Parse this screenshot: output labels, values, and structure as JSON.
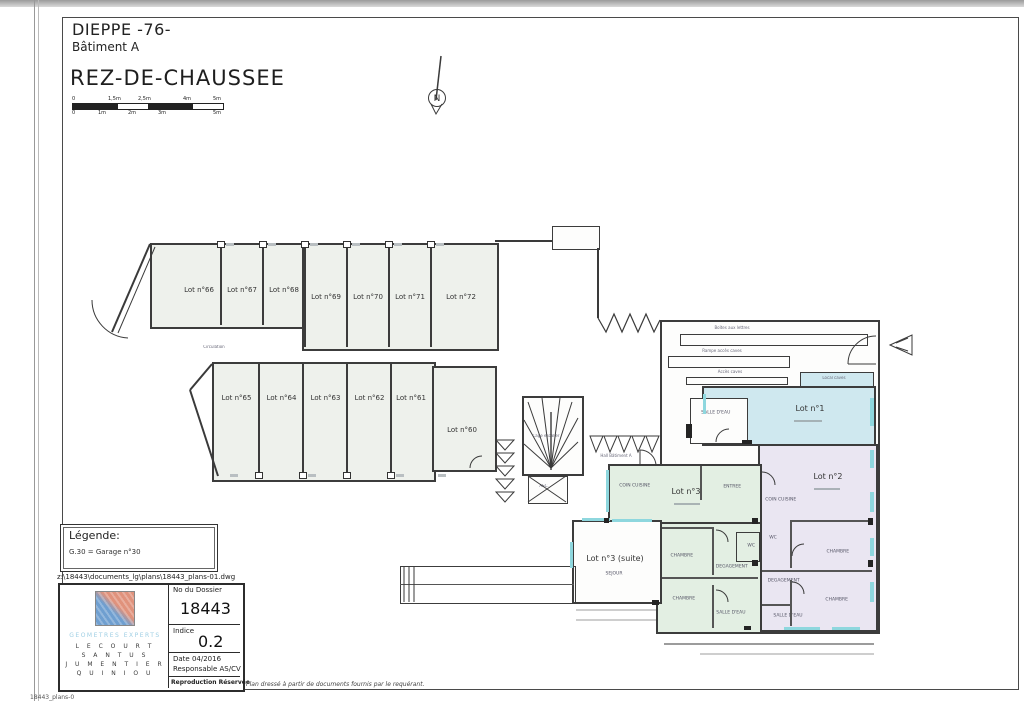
{
  "header": {
    "city": "DIEPPE -76-",
    "building": "Bâtiment A",
    "floor": "REZ-DE-CHAUSSEE"
  },
  "scale": {
    "top": [
      "0",
      "1,5m",
      "2,5m",
      "4m",
      "5m"
    ],
    "bottom": [
      "0",
      "1m",
      "2m",
      "3m",
      "5m"
    ]
  },
  "north": "N",
  "garages": {
    "top_row": [
      "Lot n°66",
      "Lot n°67",
      "Lot n°68",
      "Lot n°69",
      "Lot n°70",
      "Lot n°71",
      "Lot n°72"
    ],
    "bottom_row": [
      "Lot n°65",
      "Lot n°64",
      "Lot n°63",
      "Lot n°62",
      "Lot n°61"
    ],
    "lot60": "Lot n°60",
    "driveway": "Circulation"
  },
  "core": {
    "stairs": "Cage escalier",
    "elevator": "ASC.",
    "hall": "Hall Bâtiment A"
  },
  "corridor": {
    "mail": "Boîtes aux lettres",
    "ramp": "Rampe accès caves",
    "access": "Accès caves",
    "caves": "Local caves"
  },
  "lot1": {
    "label": "Lot n°1",
    "sdb": "SALLE D'EAU"
  },
  "lot2": {
    "label": "Lot n°2",
    "kitchen": "COIN CUISINE",
    "wc": "WC",
    "bed1": "CHAMBRE",
    "hall": "DEGAGEMENT",
    "bed2": "CHAMBRE",
    "sdb": "SALLE D'EAU"
  },
  "lot3": {
    "label": "Lot n°3",
    "kitchen": "COIN CUISINE",
    "entry": "ENTREE",
    "bed1": "CHAMBRE",
    "hall": "DEGAGEMENT",
    "wc": "WC",
    "bed2": "CHAMBRE",
    "sdb": "SALLE D'EAU",
    "suite_label": "Lot n°3 (suite)",
    "suite_sub": "SEJOUR"
  },
  "legend": {
    "title": "Légende:",
    "entry": "G.30 = Garage n°30"
  },
  "file_path": "z:\\18443\\documents_lg\\plans\\18443_plans-01.dwg",
  "title_block": {
    "firm": "GEOMETRES EXPERTS",
    "partners": [
      "L E C O U R T",
      "S A N T U S",
      "J U M E N T I E R",
      "Q U I N I O U"
    ],
    "dossier_label": "No du Dossier",
    "dossier": "18443",
    "indice_label": "Indice",
    "indice": "0.2",
    "date_label": "Date  04/2016",
    "resp_label": "Responsable AS/CV",
    "reproduction": "Reproduction Réservée"
  },
  "footer_note": "Plan dressé à partir de documents fournis par le requérant.",
  "corner_text": "18443_plans-0"
}
